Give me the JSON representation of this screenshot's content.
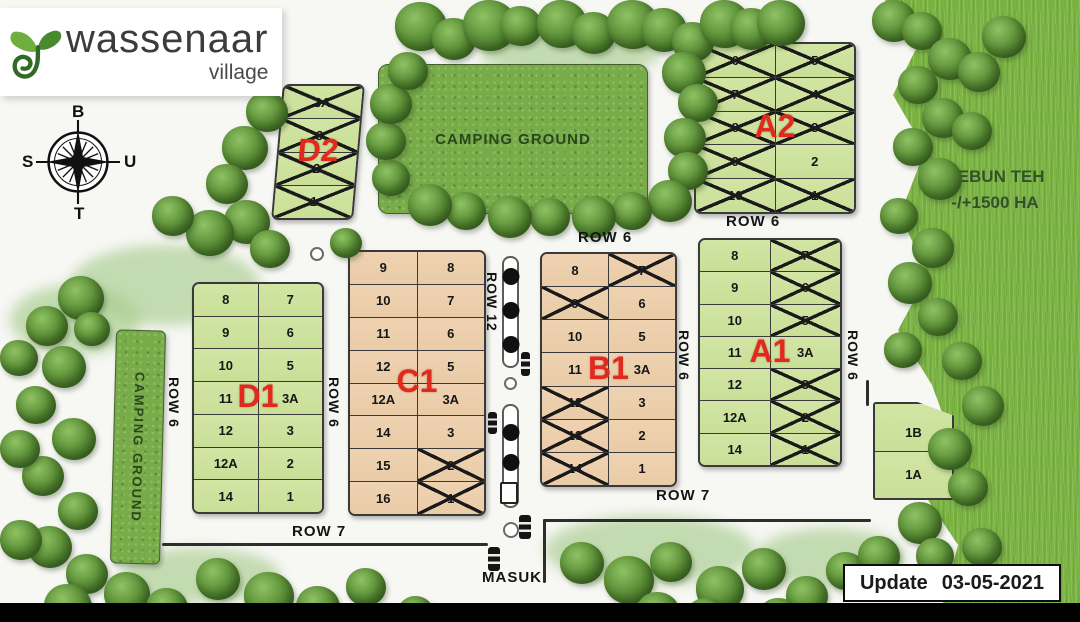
{
  "logo": {
    "title": "wassenaar",
    "subtitle": "village"
  },
  "compass": {
    "top": "B",
    "right": "U",
    "left": "S",
    "bottom": "T"
  },
  "areas": {
    "camping_top": "CAMPING GROUND",
    "camping_left": "CAMPING GROUND",
    "kebun_teh": {
      "line1": "KEBUN TEH",
      "line2": "-/+1500 HA"
    },
    "entrance": "MASUK"
  },
  "road_labels": {
    "a2_bottom": "ROW 6",
    "b1_top": "ROW 6",
    "d1_left": "ROW 6",
    "d1_right": "ROW 6",
    "b1_right": "ROW 6",
    "a1_right": "ROW 6",
    "center_vertical": "ROW 12",
    "bottom_left": "ROW 7",
    "bottom_right": "ROW 7"
  },
  "update": {
    "label": "Update",
    "date": "03-05-2021"
  },
  "colors": {
    "accent_red": "#e2291d",
    "plot_green": "#cfe3a0",
    "plot_tan": "#eecfab",
    "grass": "#7cb544",
    "camp_green": "#78ac49"
  },
  "blocks": [
    {
      "id": "d2",
      "label": "D2",
      "fill": "green",
      "columns": [
        [
          {
            "n": "3A",
            "x": true
          },
          {
            "n": "3",
            "x": true
          },
          {
            "n": "2",
            "x": true
          },
          {
            "n": "1",
            "x": true
          }
        ]
      ]
    },
    {
      "id": "a2",
      "label": "A2",
      "fill": "green",
      "columns": [
        [
          {
            "n": "6",
            "x": true
          },
          {
            "n": "7",
            "x": true
          },
          {
            "n": "8",
            "x": true
          },
          {
            "n": "9",
            "x": true
          },
          {
            "n": "10",
            "x": true
          }
        ],
        [
          {
            "n": "5",
            "x": true
          },
          {
            "n": "4",
            "x": true
          },
          {
            "n": "3",
            "x": true
          },
          {
            "n": "2",
            "x": false
          },
          {
            "n": "1",
            "x": true
          }
        ]
      ]
    },
    {
      "id": "d1",
      "label": "D1",
      "fill": "green",
      "columns": [
        [
          {
            "n": "8"
          },
          {
            "n": "9"
          },
          {
            "n": "10"
          },
          {
            "n": "11"
          },
          {
            "n": "12"
          },
          {
            "n": "12A"
          },
          {
            "n": "14"
          }
        ],
        [
          {
            "n": "7"
          },
          {
            "n": "6"
          },
          {
            "n": "5"
          },
          {
            "n": "3A"
          },
          {
            "n": "3"
          },
          {
            "n": "2"
          },
          {
            "n": "1"
          }
        ]
      ]
    },
    {
      "id": "c1",
      "label": "C1",
      "fill": "tan",
      "columns": [
        [
          {
            "n": "9"
          },
          {
            "n": "10"
          },
          {
            "n": "11"
          },
          {
            "n": "12"
          },
          {
            "n": "12A"
          },
          {
            "n": "14"
          },
          {
            "n": "15"
          },
          {
            "n": "16"
          }
        ],
        [
          {
            "n": "8"
          },
          {
            "n": "7"
          },
          {
            "n": "6"
          },
          {
            "n": "5"
          },
          {
            "n": "3A"
          },
          {
            "n": "3"
          },
          {
            "n": "2",
            "x": true
          },
          {
            "n": "1",
            "x": true
          }
        ]
      ]
    },
    {
      "id": "b1",
      "label": "B1",
      "fill": "tan",
      "columns": [
        [
          {
            "n": "8"
          },
          {
            "n": "9",
            "x": true
          },
          {
            "n": "10"
          },
          {
            "n": "11"
          },
          {
            "n": "12",
            "x": true
          },
          {
            "n": "13",
            "x": true
          },
          {
            "n": "14",
            "x": true
          }
        ],
        [
          {
            "n": "7",
            "x": true
          },
          {
            "n": "6"
          },
          {
            "n": "5"
          },
          {
            "n": "3A"
          },
          {
            "n": "3"
          },
          {
            "n": "2"
          },
          {
            "n": "1"
          }
        ]
      ]
    },
    {
      "id": "a1",
      "label": "A1",
      "fill": "green",
      "columns": [
        [
          {
            "n": "8"
          },
          {
            "n": "9"
          },
          {
            "n": "10"
          },
          {
            "n": "11"
          },
          {
            "n": "12"
          },
          {
            "n": "12A"
          },
          {
            "n": "14"
          }
        ],
        [
          {
            "n": "7",
            "x": true
          },
          {
            "n": "6",
            "x": true
          },
          {
            "n": "5",
            "x": true
          },
          {
            "n": "3A"
          },
          {
            "n": "3",
            "x": true
          },
          {
            "n": "2",
            "x": true
          },
          {
            "n": "1",
            "x": true
          }
        ]
      ]
    },
    {
      "id": "ab",
      "label": "",
      "fill": "green",
      "columns": [
        [
          {
            "n": "1B"
          },
          {
            "n": "1A"
          }
        ]
      ]
    }
  ]
}
